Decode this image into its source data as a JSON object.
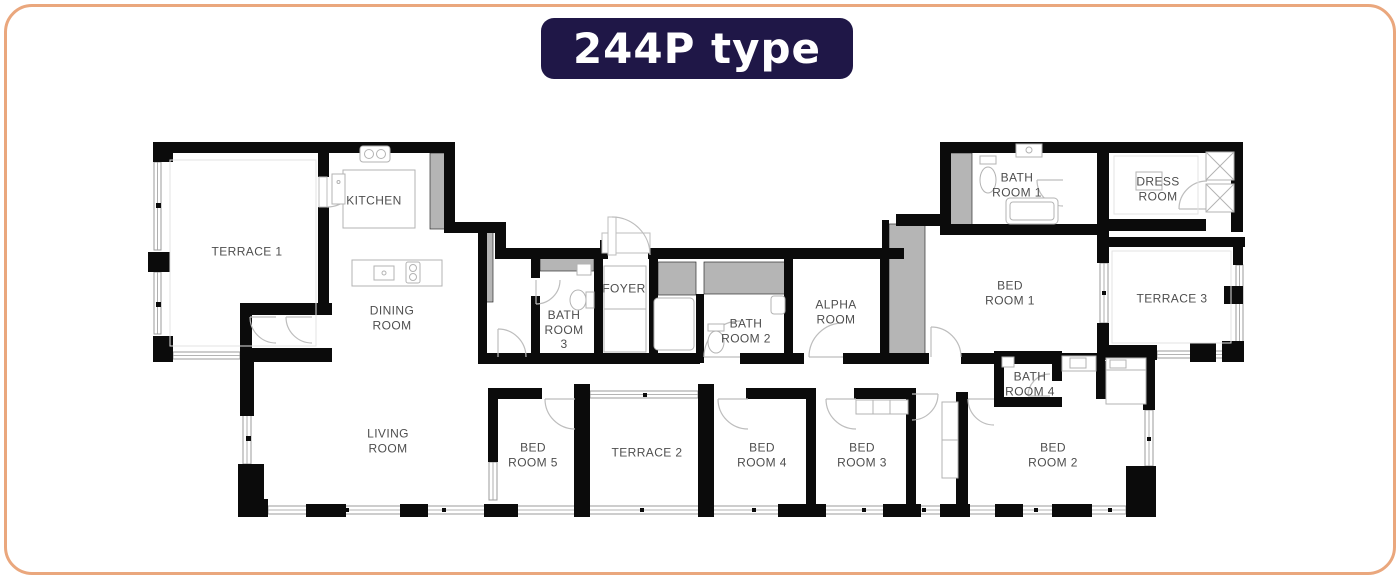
{
  "title": "244P type",
  "colors": {
    "border-orange": "#EAA77D",
    "title-bg": "#1F1747",
    "title-text": "#FFFFFF",
    "wall": "#0B0B0B",
    "wall-gray": "#B5B5B5",
    "label": "#4E4E4E"
  },
  "rooms": {
    "terrace1": "TERRACE 1",
    "kitchen": "KITCHEN",
    "dining": "DINING\nROOM",
    "living": "LIVING\nROOM",
    "bath3": "BATH\nROOM\n3",
    "foyer": "FOYER",
    "bath2": "BATH\nROOM 2",
    "alpha": "ALPHA\nROOM",
    "bed1": "BED\nROOM 1",
    "bath1": "BATH\nROOM 1",
    "dress": "DRESS\nROOM",
    "terrace3": "TERRACE 3",
    "bath4": "BATH\nROOM 4",
    "bed2": "BED\nROOM 2",
    "bed3": "BED\nROOM 3",
    "bed4": "BED\nROOM 4",
    "terrace2": "TERRACE 2",
    "bed5": "BED\nROOM 5"
  }
}
